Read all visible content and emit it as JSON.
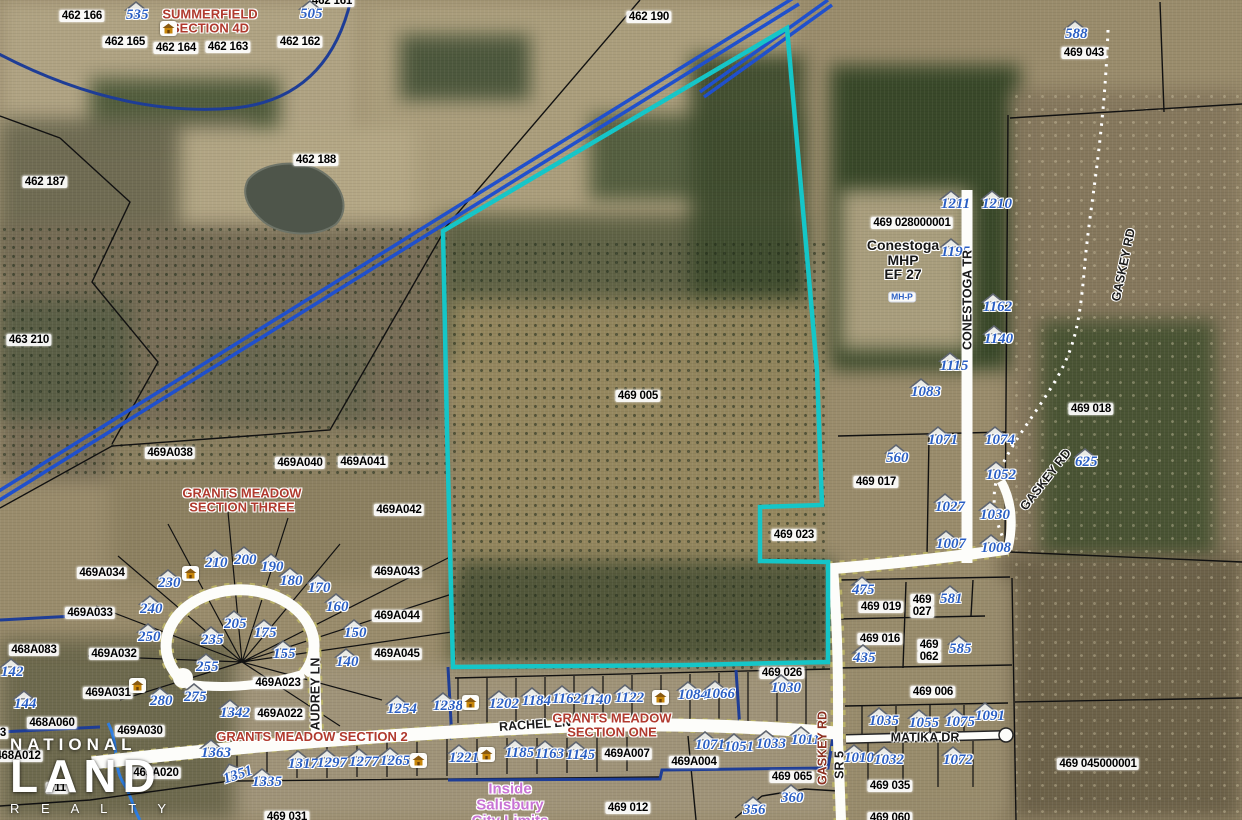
{
  "map": {
    "title": "Aerial parcel map",
    "colors": {
      "subject_boundary": "#15c6c8",
      "water_line": "#2e7de0",
      "city_limit": "#1e3d96",
      "corridor_line": "#2050cc",
      "address_text": "#2a5fc4",
      "subdivision_text": "#b03a2e",
      "city_text": "#c873d4",
      "road_text": "#1a1a1a",
      "gaskey_south_text": "#8b2f1f"
    },
    "logo": {
      "line1": "NATIONAL",
      "line2": "LAND",
      "line3": "R E A L T Y"
    },
    "parcel_labels": [
      {
        "t": "462 166",
        "x": 82,
        "y": 16
      },
      {
        "t": "462 165",
        "x": 125,
        "y": 42
      },
      {
        "t": "462 164",
        "x": 176,
        "y": 48
      },
      {
        "t": "462 163",
        "x": 228,
        "y": 47
      },
      {
        "t": "462 162",
        "x": 300,
        "y": 42
      },
      {
        "t": "462 161",
        "x": 332,
        "y": 1
      },
      {
        "t": "462 190",
        "x": 649,
        "y": 17
      },
      {
        "t": "469 043",
        "x": 1084,
        "y": 53
      },
      {
        "t": "462 187",
        "x": 45,
        "y": 182
      },
      {
        "t": "462 188",
        "x": 316,
        "y": 160
      },
      {
        "t": "463 210",
        "x": 29,
        "y": 340
      },
      {
        "t": "469 028000001",
        "x": 912,
        "y": 223
      },
      {
        "t": "469 005",
        "x": 638,
        "y": 396
      },
      {
        "t": "469 018",
        "x": 1091,
        "y": 409
      },
      {
        "t": "469 017",
        "x": 876,
        "y": 482
      },
      {
        "t": "469 023",
        "x": 794,
        "y": 535
      },
      {
        "t": "469A038",
        "x": 170,
        "y": 453
      },
      {
        "t": "469A040",
        "x": 300,
        "y": 463
      },
      {
        "t": "469A041",
        "x": 363,
        "y": 462
      },
      {
        "t": "469A042",
        "x": 399,
        "y": 510
      },
      {
        "t": "469A034",
        "x": 102,
        "y": 573
      },
      {
        "t": "469A033",
        "x": 90,
        "y": 613
      },
      {
        "t": "468A083",
        "x": 34,
        "y": 650
      },
      {
        "t": "469A032",
        "x": 114,
        "y": 654
      },
      {
        "t": "469A031",
        "x": 108,
        "y": 693
      },
      {
        "t": "468A060",
        "x": 52,
        "y": 723
      },
      {
        "t": "469A030",
        "x": 140,
        "y": 731
      },
      {
        "t": "468A012",
        "x": 18,
        "y": 756
      },
      {
        "t": "469A020",
        "x": 156,
        "y": 773
      },
      {
        "t": "011",
        "x": 57,
        "y": 788
      },
      {
        "t": "3",
        "x": 3,
        "y": 733
      },
      {
        "t": "469 031",
        "x": 287,
        "y": 817
      },
      {
        "t": "469A023",
        "x": 278,
        "y": 683
      },
      {
        "t": "469A022",
        "x": 280,
        "y": 714
      },
      {
        "t": "469A043",
        "x": 397,
        "y": 572
      },
      {
        "t": "469A044",
        "x": 397,
        "y": 616
      },
      {
        "t": "469A045",
        "x": 397,
        "y": 654
      },
      {
        "t": "469A007",
        "x": 627,
        "y": 754
      },
      {
        "t": "469A004",
        "x": 694,
        "y": 762
      },
      {
        "t": "469 026",
        "x": 782,
        "y": 673
      },
      {
        "t": "469 019",
        "x": 881,
        "y": 607
      },
      {
        "lines": [
          "469",
          "027"
        ],
        "x": 922,
        "y": 606
      },
      {
        "t": "469 016",
        "x": 880,
        "y": 639
      },
      {
        "lines": [
          "469",
          "062"
        ],
        "x": 929,
        "y": 651
      },
      {
        "t": "469 006",
        "x": 933,
        "y": 692
      },
      {
        "t": "469 065",
        "x": 792,
        "y": 777
      },
      {
        "t": "469 012",
        "x": 628,
        "y": 808
      },
      {
        "t": "469 035",
        "x": 890,
        "y": 786
      },
      {
        "t": "469 060",
        "x": 890,
        "y": 818
      },
      {
        "t": "469 045000001",
        "x": 1098,
        "y": 764
      }
    ],
    "address_labels": [
      {
        "t": "535",
        "x": 138,
        "y": 15
      },
      {
        "t": "505",
        "x": 312,
        "y": 14
      },
      {
        "t": "588",
        "x": 1077,
        "y": 34
      },
      {
        "t": "1211",
        "x": 953,
        "y": 204
      },
      {
        "t": "1210",
        "x": 994,
        "y": 204
      },
      {
        "t": "1195",
        "x": 953,
        "y": 252
      },
      {
        "t": "1162",
        "x": 995,
        "y": 307
      },
      {
        "t": "1140",
        "x": 996,
        "y": 339
      },
      {
        "t": "1115",
        "x": 952,
        "y": 366
      },
      {
        "t": "1083",
        "x": 923,
        "y": 392
      },
      {
        "t": "1071",
        "x": 940,
        "y": 440
      },
      {
        "t": "1074",
        "x": 997,
        "y": 440
      },
      {
        "t": "625",
        "x": 1087,
        "y": 462
      },
      {
        "t": "1052",
        "x": 998,
        "y": 475
      },
      {
        "t": "560",
        "x": 898,
        "y": 458
      },
      {
        "t": "1027",
        "x": 947,
        "y": 507
      },
      {
        "t": "1030",
        "x": 992,
        "y": 515
      },
      {
        "t": "1007",
        "x": 948,
        "y": 544
      },
      {
        "t": "1008",
        "x": 993,
        "y": 548
      },
      {
        "t": "475",
        "x": 864,
        "y": 590
      },
      {
        "t": "581",
        "x": 952,
        "y": 599
      },
      {
        "t": "435",
        "x": 865,
        "y": 658
      },
      {
        "t": "585",
        "x": 961,
        "y": 649
      },
      {
        "t": "210",
        "x": 217,
        "y": 563
      },
      {
        "t": "200",
        "x": 246,
        "y": 560
      },
      {
        "t": "190",
        "x": 273,
        "y": 567
      },
      {
        "t": "230",
        "x": 170,
        "y": 583
      },
      {
        "t": "180",
        "x": 292,
        "y": 581
      },
      {
        "t": "170",
        "x": 320,
        "y": 588
      },
      {
        "t": "240",
        "x": 152,
        "y": 609
      },
      {
        "t": "160",
        "x": 338,
        "y": 607
      },
      {
        "t": "205",
        "x": 236,
        "y": 624
      },
      {
        "t": "175",
        "x": 266,
        "y": 633
      },
      {
        "t": "150",
        "x": 356,
        "y": 633
      },
      {
        "t": "250",
        "x": 150,
        "y": 637
      },
      {
        "t": "235",
        "x": 213,
        "y": 640
      },
      {
        "t": "155",
        "x": 285,
        "y": 654
      },
      {
        "t": "140",
        "x": 348,
        "y": 662
      },
      {
        "t": "255",
        "x": 208,
        "y": 667
      },
      {
        "t": "280",
        "x": 162,
        "y": 701
      },
      {
        "t": "275",
        "x": 196,
        "y": 697
      },
      {
        "t": "142",
        "x": 13,
        "y": 672
      },
      {
        "t": "144",
        "x": 26,
        "y": 704
      },
      {
        "t": "1342",
        "x": 232,
        "y": 713
      },
      {
        "t": "1254",
        "x": 399,
        "y": 709
      },
      {
        "t": "1238",
        "x": 445,
        "y": 706
      },
      {
        "t": "1202",
        "x": 501,
        "y": 704
      },
      {
        "t": "1184",
        "x": 534,
        "y": 701
      },
      {
        "t": "1162",
        "x": 564,
        "y": 699
      },
      {
        "t": "1140",
        "x": 594,
        "y": 700
      },
      {
        "t": "1122",
        "x": 627,
        "y": 698
      },
      {
        "t": "1084",
        "x": 690,
        "y": 695
      },
      {
        "t": "1066",
        "x": 717,
        "y": 694
      },
      {
        "t": "1030",
        "x": 783,
        "y": 688
      },
      {
        "t": "1363",
        "x": 213,
        "y": 753
      },
      {
        "t": "1351",
        "x": 235,
        "y": 776,
        "r": -18
      },
      {
        "t": "1335",
        "x": 264,
        "y": 782
      },
      {
        "t": "1317",
        "x": 300,
        "y": 764
      },
      {
        "t": "1297",
        "x": 329,
        "y": 763
      },
      {
        "t": "1277",
        "x": 361,
        "y": 762
      },
      {
        "t": "1265",
        "x": 392,
        "y": 761
      },
      {
        "t": "1221",
        "x": 461,
        "y": 758
      },
      {
        "t": "1185",
        "x": 517,
        "y": 753
      },
      {
        "t": "1163",
        "x": 547,
        "y": 754
      },
      {
        "t": "1145",
        "x": 578,
        "y": 755
      },
      {
        "t": "1071",
        "x": 707,
        "y": 745
      },
      {
        "t": "1051",
        "x": 736,
        "y": 747
      },
      {
        "t": "1033",
        "x": 768,
        "y": 744
      },
      {
        "t": "1011",
        "x": 803,
        "y": 740
      },
      {
        "t": "1035",
        "x": 881,
        "y": 721
      },
      {
        "t": "1055",
        "x": 921,
        "y": 723
      },
      {
        "t": "1075",
        "x": 957,
        "y": 722
      },
      {
        "t": "1091",
        "x": 987,
        "y": 716
      },
      {
        "t": "1010",
        "x": 856,
        "y": 758
      },
      {
        "t": "1032",
        "x": 886,
        "y": 760
      },
      {
        "t": "1072",
        "x": 955,
        "y": 760
      },
      {
        "t": "356",
        "x": 755,
        "y": 810
      },
      {
        "t": "360",
        "x": 793,
        "y": 798
      }
    ],
    "road_labels": [
      {
        "t": "CONESTOGA TR",
        "x": 968,
        "y": 300,
        "r": -90
      },
      {
        "t": "GASKEY RD",
        "x": 1124,
        "y": 265,
        "r": -78
      },
      {
        "t": "GASKEY RD",
        "x": 1046,
        "y": 480,
        "r": -52
      },
      {
        "t": "GASKEY RD",
        "x": 823,
        "y": 748,
        "r": -90,
        "c": "#8b2f1f"
      },
      {
        "t": "SR 5",
        "x": 840,
        "y": 765,
        "r": -90
      },
      {
        "t": "RACHEL LN",
        "x": 535,
        "y": 725,
        "r": -4
      },
      {
        "t": "MATIKA DR",
        "x": 925,
        "y": 738,
        "r": 0
      },
      {
        "t": "AUDREY LN",
        "x": 316,
        "y": 694,
        "r": -90
      }
    ],
    "subdivision_labels": [
      {
        "lines": [
          "SUMMERFIELD",
          "SECTION 4D"
        ],
        "x": 210,
        "y": 21
      },
      {
        "lines": [
          "GRANTS MEADOW",
          "SECTION THREE"
        ],
        "x": 242,
        "y": 500
      },
      {
        "lines": [
          "GRANTS MEADOW SECTION 2"
        ],
        "x": 312,
        "y": 737
      },
      {
        "lines": [
          "GRANTS MEADOW",
          "SECTION ONE"
        ],
        "x": 612,
        "y": 725
      }
    ],
    "place_labels": [
      {
        "lines": [
          "Conestoga",
          "MHP",
          "EF 27"
        ],
        "x": 903,
        "y": 260,
        "c": "#161616",
        "fs": 14,
        "fw": "bold"
      },
      {
        "lines": [
          "Inside",
          "Salisbury",
          "City Limits"
        ],
        "x": 510,
        "y": 805,
        "c": "#c873d4",
        "fs": 15,
        "fw": "bold"
      }
    ],
    "chip_labels": [
      {
        "t": "MH-P",
        "x": 902,
        "y": 297
      }
    ],
    "house_icons": [
      {
        "x": 168,
        "y": 28
      },
      {
        "x": 190,
        "y": 573
      },
      {
        "x": 137,
        "y": 685
      },
      {
        "x": 470,
        "y": 702
      },
      {
        "x": 660,
        "y": 697
      },
      {
        "x": 418,
        "y": 760
      },
      {
        "x": 486,
        "y": 754
      }
    ]
  }
}
